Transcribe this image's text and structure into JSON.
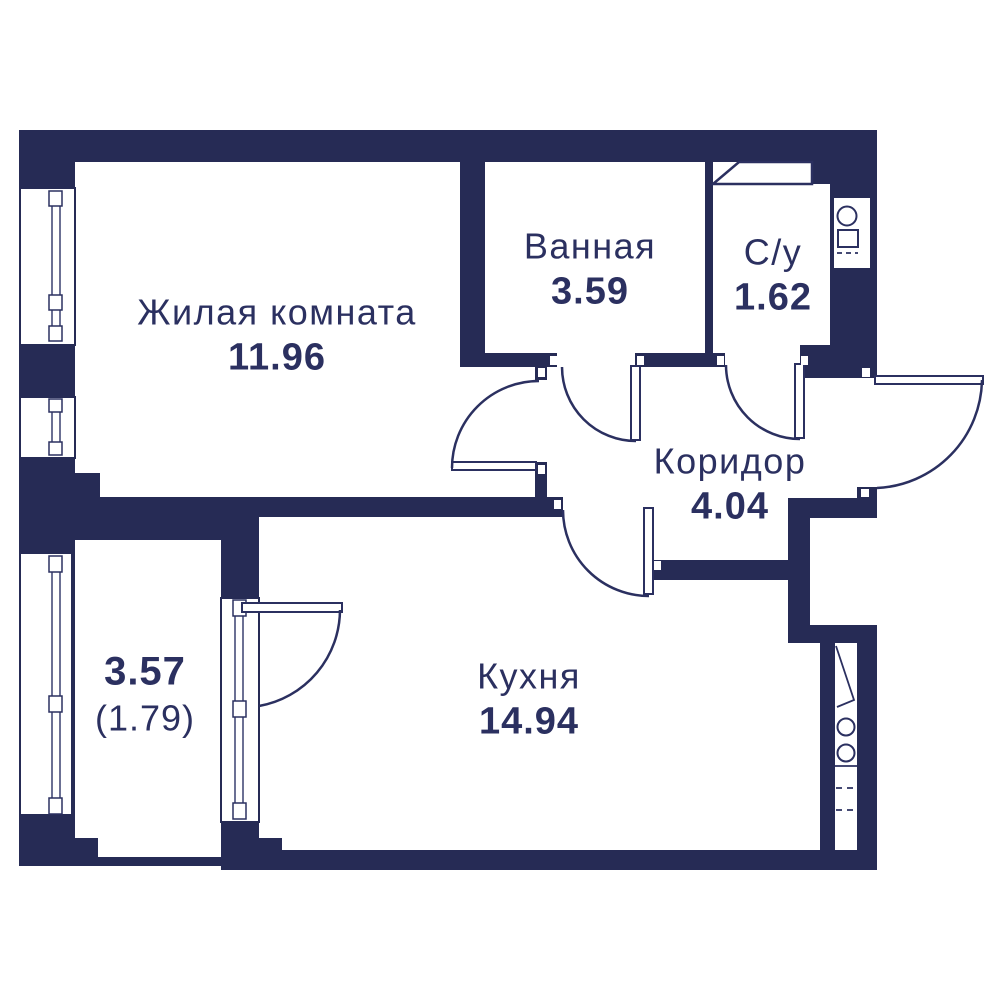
{
  "plan": {
    "title": "apartment-floor-plan",
    "background_color": "#ffffff",
    "wall_color": "#262b55",
    "line_color": "#2b3060",
    "text_color": "#2b3060"
  },
  "rooms": [
    {
      "id": "living",
      "name": "Жилая комната",
      "area": "11.96"
    },
    {
      "id": "bathroom",
      "name": "Ванная",
      "area": "3.59"
    },
    {
      "id": "wc",
      "name": "С/у",
      "area": "1.62"
    },
    {
      "id": "corridor",
      "name": "Коридор",
      "area": "4.04"
    },
    {
      "id": "kitchen",
      "name": "Кухня",
      "area": "14.94"
    },
    {
      "id": "balcony",
      "name": "",
      "area": "3.57",
      "area_secondary": "(1.79)"
    }
  ],
  "features": {
    "windows": [
      "living-window-large",
      "living-window-small",
      "balcony-glazing",
      "balcony-kitchen-glazing"
    ],
    "doors": [
      "living-room-door",
      "bathroom-door",
      "wc-door",
      "kitchen-door",
      "balcony-door",
      "entrance-door"
    ],
    "fixtures": [
      "ventilation-duct",
      "wc-riser-shaft",
      "kitchen-riser-shaft"
    ]
  }
}
